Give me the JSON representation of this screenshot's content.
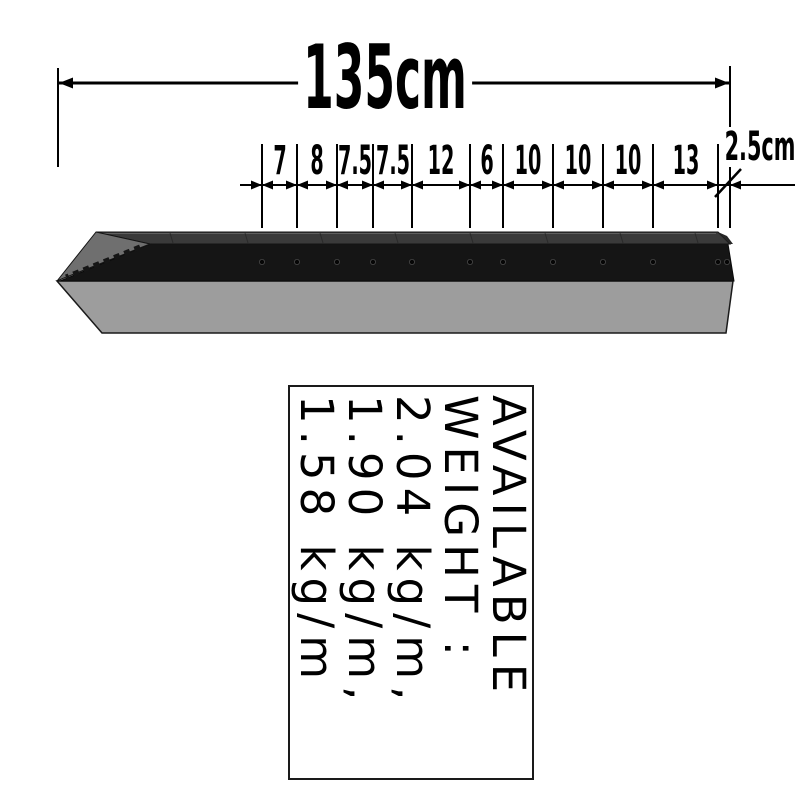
{
  "dimensions": {
    "overall": "135cm",
    "segments": [
      "7",
      "8",
      "7.5",
      "7.5",
      "12",
      "6",
      "10",
      "10",
      "10",
      "13"
    ],
    "end_segment": "2.5cm",
    "unit_note": "cm"
  },
  "weight_box": {
    "lines": [
      "AVAILABLE",
      "WEIGHT :",
      "2.04 kg/m,",
      "1.90 kg/m,",
      "1.58 kg/m"
    ]
  },
  "post": {
    "hole_count": 12
  },
  "colors": {
    "line": "#000000",
    "background": "#ffffff",
    "post_top_face": "#3a3a3a",
    "post_web_face": "#151515",
    "post_flange_face": "#9d9d9d",
    "post_chamfer_face": "#6f6f6f"
  }
}
